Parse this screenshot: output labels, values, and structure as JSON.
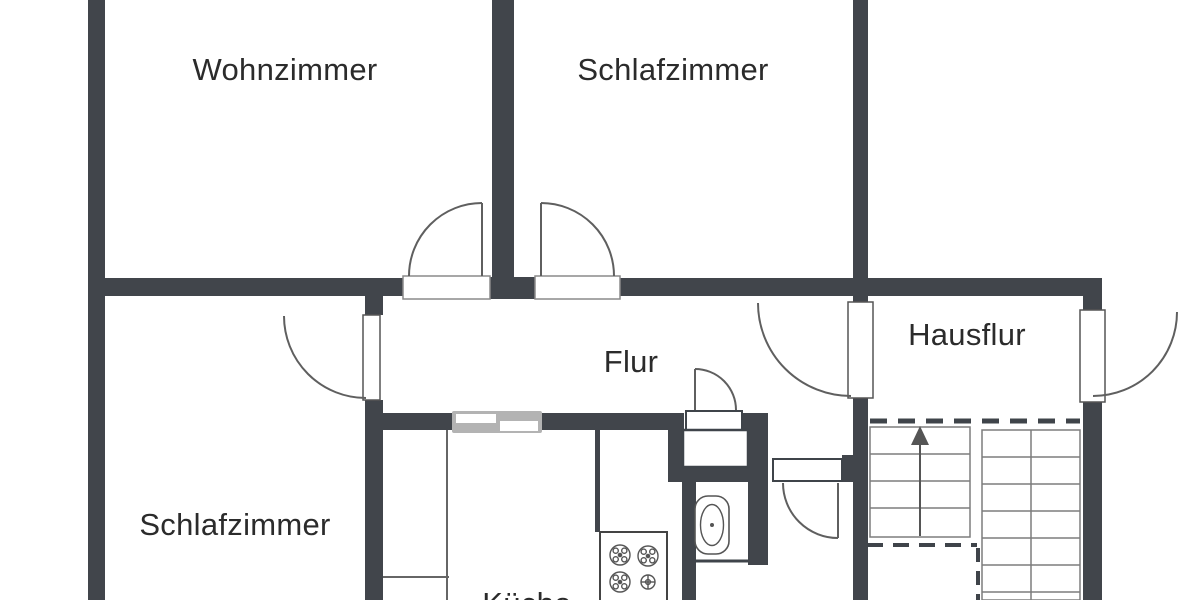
{
  "rooms": {
    "wohnzimmer": {
      "name": "Wohnzimmer"
    },
    "schlafzimmer_top": {
      "name": "Schlafzimmer"
    },
    "flur": {
      "name": "Flur"
    },
    "hausflur": {
      "name": "Hausflur"
    },
    "schlafzimmer_bottom": {
      "name": "Schlafzimmer"
    },
    "kueche_clipped": {
      "name": "Küche"
    }
  },
  "fixtures": {
    "staircase": {
      "direction_arrow": "up",
      "flights": 2
    },
    "stove": {
      "burners": 4
    },
    "toilet": 1,
    "sliding_door": 1,
    "swing_doors": 7
  },
  "colors": {
    "wall": "#41454b",
    "thin_line": "#5f5f5f",
    "stair_line": "#7d7d7d",
    "sliding_door_track": "#b3b3b3",
    "text": "#2b2b2b",
    "background": "#ffffff"
  }
}
